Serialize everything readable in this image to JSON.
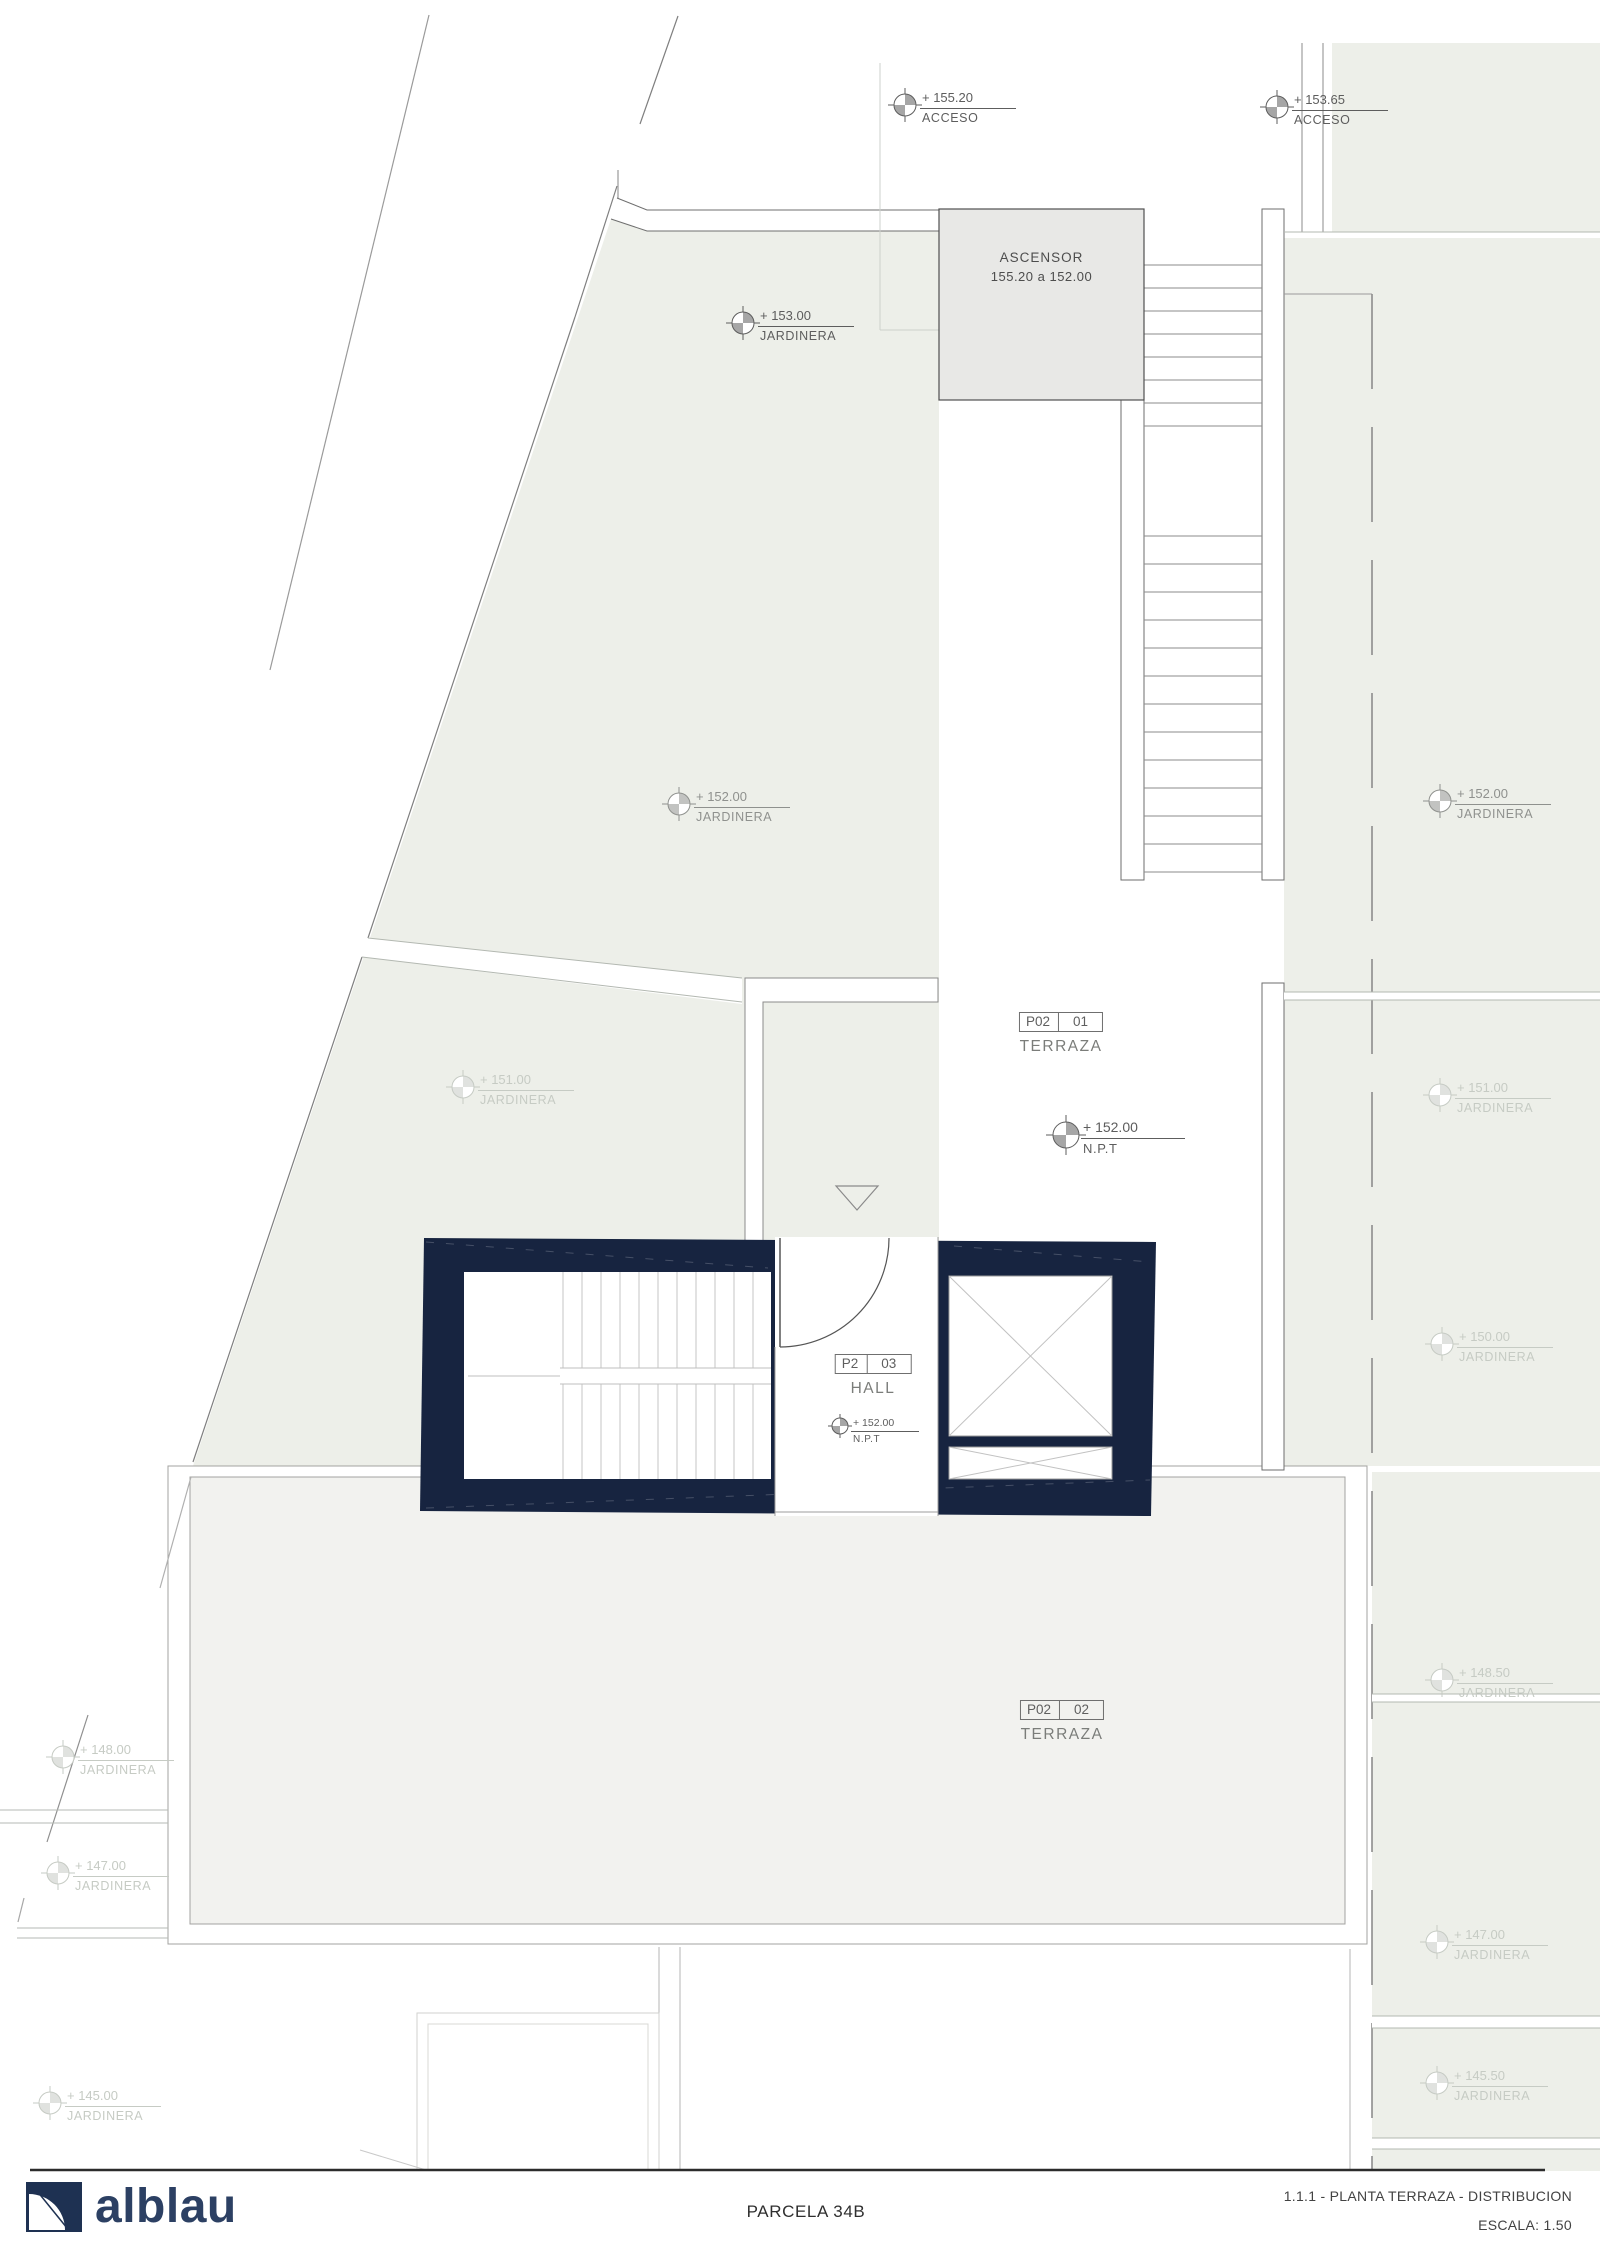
{
  "ascensor": {
    "line1": "ASCENSOR",
    "line2": "155.20 a 152.00"
  },
  "markers": [
    {
      "x": 905,
      "y": 105,
      "value": "+ 155.20",
      "label": "ACCESO",
      "tone": "dark",
      "size": "md"
    },
    {
      "x": 1277,
      "y": 107,
      "value": "+ 153.65",
      "label": "ACCESO",
      "tone": "dark",
      "size": "md"
    },
    {
      "x": 743,
      "y": 323,
      "value": "+ 153.00",
      "label": "JARDINERA",
      "tone": "dark",
      "size": "md"
    },
    {
      "x": 679,
      "y": 804,
      "value": "+ 152.00",
      "label": "JARDINERA",
      "tone": "mid",
      "size": "md"
    },
    {
      "x": 1440,
      "y": 801,
      "value": "+ 152.00",
      "label": "JARDINERA",
      "tone": "mid",
      "size": "md"
    },
    {
      "x": 463,
      "y": 1087,
      "value": "+ 151.00",
      "label": "JARDINERA",
      "tone": "faint",
      "size": "md"
    },
    {
      "x": 1440,
      "y": 1095,
      "value": "+ 151.00",
      "label": "JARDINERA",
      "tone": "faint",
      "size": "md"
    },
    {
      "x": 1442,
      "y": 1344,
      "value": "+ 150.00",
      "label": "JARDINERA",
      "tone": "faint",
      "size": "md"
    },
    {
      "x": 1442,
      "y": 1680,
      "value": "+ 148.50",
      "label": "JARDINERA",
      "tone": "faint",
      "size": "md"
    },
    {
      "x": 1437,
      "y": 1942,
      "value": "+ 147.00",
      "label": "JARDINERA",
      "tone": "faint",
      "size": "md"
    },
    {
      "x": 1437,
      "y": 2083,
      "value": "+ 145.50",
      "label": "JARDINERA",
      "tone": "faint",
      "size": "md"
    },
    {
      "x": 63,
      "y": 1757,
      "value": "+ 148.00",
      "label": "JARDINERA",
      "tone": "faint",
      "size": "md"
    },
    {
      "x": 58,
      "y": 1873,
      "value": "+ 147.00",
      "label": "JARDINERA",
      "tone": "faint",
      "size": "md"
    },
    {
      "x": 50,
      "y": 2103,
      "value": "+ 145.00",
      "label": "JARDINERA",
      "tone": "faint",
      "size": "md"
    },
    {
      "x": 1066,
      "y": 1135,
      "value": "+ 152.00",
      "label": "N.P.T",
      "tone": "dark",
      "size": "lg"
    },
    {
      "x": 840,
      "y": 1426,
      "value": "+ 152.00",
      "label": "N.P.T",
      "tone": "dark",
      "size": "sm"
    }
  ],
  "room_labels": [
    {
      "x": 1061,
      "y": 1012,
      "left": "P02",
      "right": "01",
      "name": "TERRAZA"
    },
    {
      "x": 1062,
      "y": 1700,
      "left": "P02",
      "right": "02",
      "name": "TERRAZA"
    },
    {
      "x": 873,
      "y": 1354,
      "left": "P2",
      "right": "03",
      "name": "HALL"
    }
  ],
  "footer": {
    "logo_text": "alblau",
    "parcel": "PARCELA 34B",
    "sheet_title": "1.1.1 - PLANTA TERRAZA -  DISTRIBUCION",
    "scale": "ESCALA: 1.50"
  },
  "colors": {
    "navy_core": "#172440",
    "logo_navy": "#1e3152",
    "terrain": "#edefe9",
    "terrace_fill": "#f2f2ef",
    "ascensor_fill": "#e8e8e6",
    "line_dark": "#4f4f4f",
    "line_mid": "#8b8b8b",
    "line_light": "#c2c7c0"
  }
}
